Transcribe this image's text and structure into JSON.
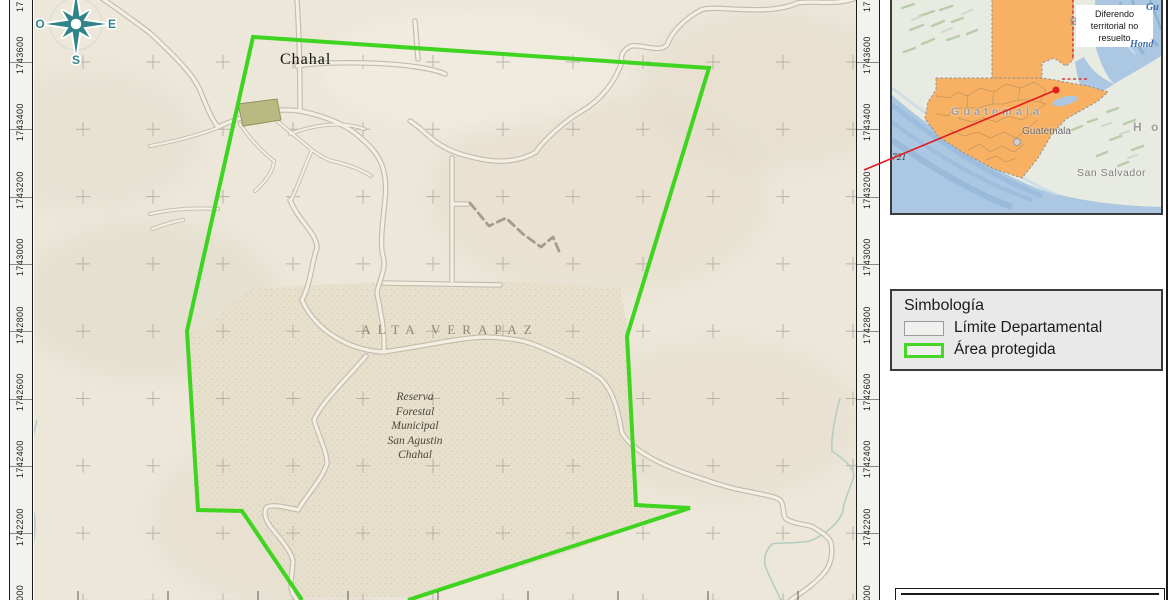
{
  "map": {
    "town_label": "Chahal",
    "department_label": "ALTA VERAPAZ",
    "reserve_label_lines": [
      "Reserva",
      "Forestal",
      "Municipal",
      "San Agustin",
      "Chahal"
    ],
    "compass": {
      "west": "O",
      "east": "E",
      "south": "S"
    },
    "axis": {
      "labels": [
        "1743600",
        "1743400",
        "1743200",
        "1743000",
        "1742800",
        "1742600",
        "1742400",
        "1742200"
      ],
      "partial_top": "17",
      "partial_bottom": "000"
    }
  },
  "inset": {
    "country_label": "Guatemala",
    "capital_label": "Guatemala",
    "note_label": "Diferendo territorial no resuelto",
    "san_salvador_label": "San Salvador",
    "honduras_partial": "H o",
    "belize_partial": "B",
    "sea_label_fragment_top": "Gu",
    "sea_label_fragment": "Hond",
    "depth_label": "721"
  },
  "legend": {
    "title": "Simbología",
    "items": [
      {
        "label": "Límite Departamental",
        "swatch_border": "#9a9b98",
        "swatch_border_width": 1
      },
      {
        "label": "Área protegida",
        "swatch_border": "#47d528",
        "swatch_border_width": 3
      }
    ]
  },
  "colors": {
    "protected_area_outline": "#3fd41f",
    "locator_line": "#e01d20",
    "guatemala_fill": "#f8b163",
    "ocean": "#abc7e2",
    "compass": "#2f8389"
  }
}
